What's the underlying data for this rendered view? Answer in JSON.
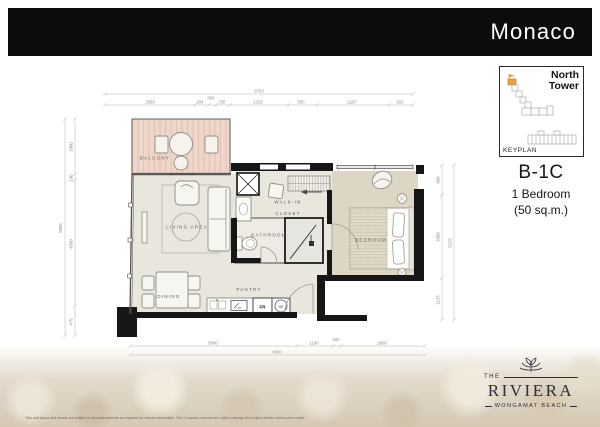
{
  "header": {
    "title": "Monaco"
  },
  "keyplan": {
    "tower_label": "North\nTower",
    "caption": "KEYPLAN",
    "highlight_color": "#e9a23b"
  },
  "unit": {
    "code": "B-1C",
    "type": "1 Bedroom",
    "area": "(50 sq.m.)"
  },
  "plan": {
    "rooms": {
      "balcony": "BALCONY",
      "living": "LIVING AREA",
      "dining": "DINING",
      "pantry": "PANTRY",
      "bathroom": "BATHROOM",
      "walkin_line1": "WALK-IN",
      "walkin_line2": "CLOSET",
      "bedroom": "BEDROOM"
    },
    "appliances": {
      "fridge": "FR",
      "washer": "W"
    },
    "dims": {
      "top_total": "9703",
      "top_segments": [
        "2950",
        "204",
        "300",
        "735",
        "2315",
        "500",
        "2297",
        "202"
      ],
      "bottom_total": "9000",
      "bottom_segments": [
        "5000",
        "1100",
        "100",
        "2800"
      ],
      "left_total": "6965",
      "left_segments": [
        "1800",
        "190",
        "4500",
        "475"
      ],
      "right_total": "5225",
      "right_segments": [
        "800",
        "3300",
        "1125"
      ]
    },
    "colors": {
      "wall": "#161616",
      "floor": "#e9e6dd",
      "bedroom_floor": "#ddd6c4",
      "balcony_deck": "#eed7ca",
      "furniture_line": "#8f8e88"
    }
  },
  "footer": {
    "logo": {
      "the": "THE",
      "name": "RIVIERA",
      "tagline": "WONGAMAT BEACH"
    },
    "disclaimer": "This unit layout and details are subject to any amendments as required by relevant authorities. The Company reserves the right to change the project details without prior notice."
  }
}
